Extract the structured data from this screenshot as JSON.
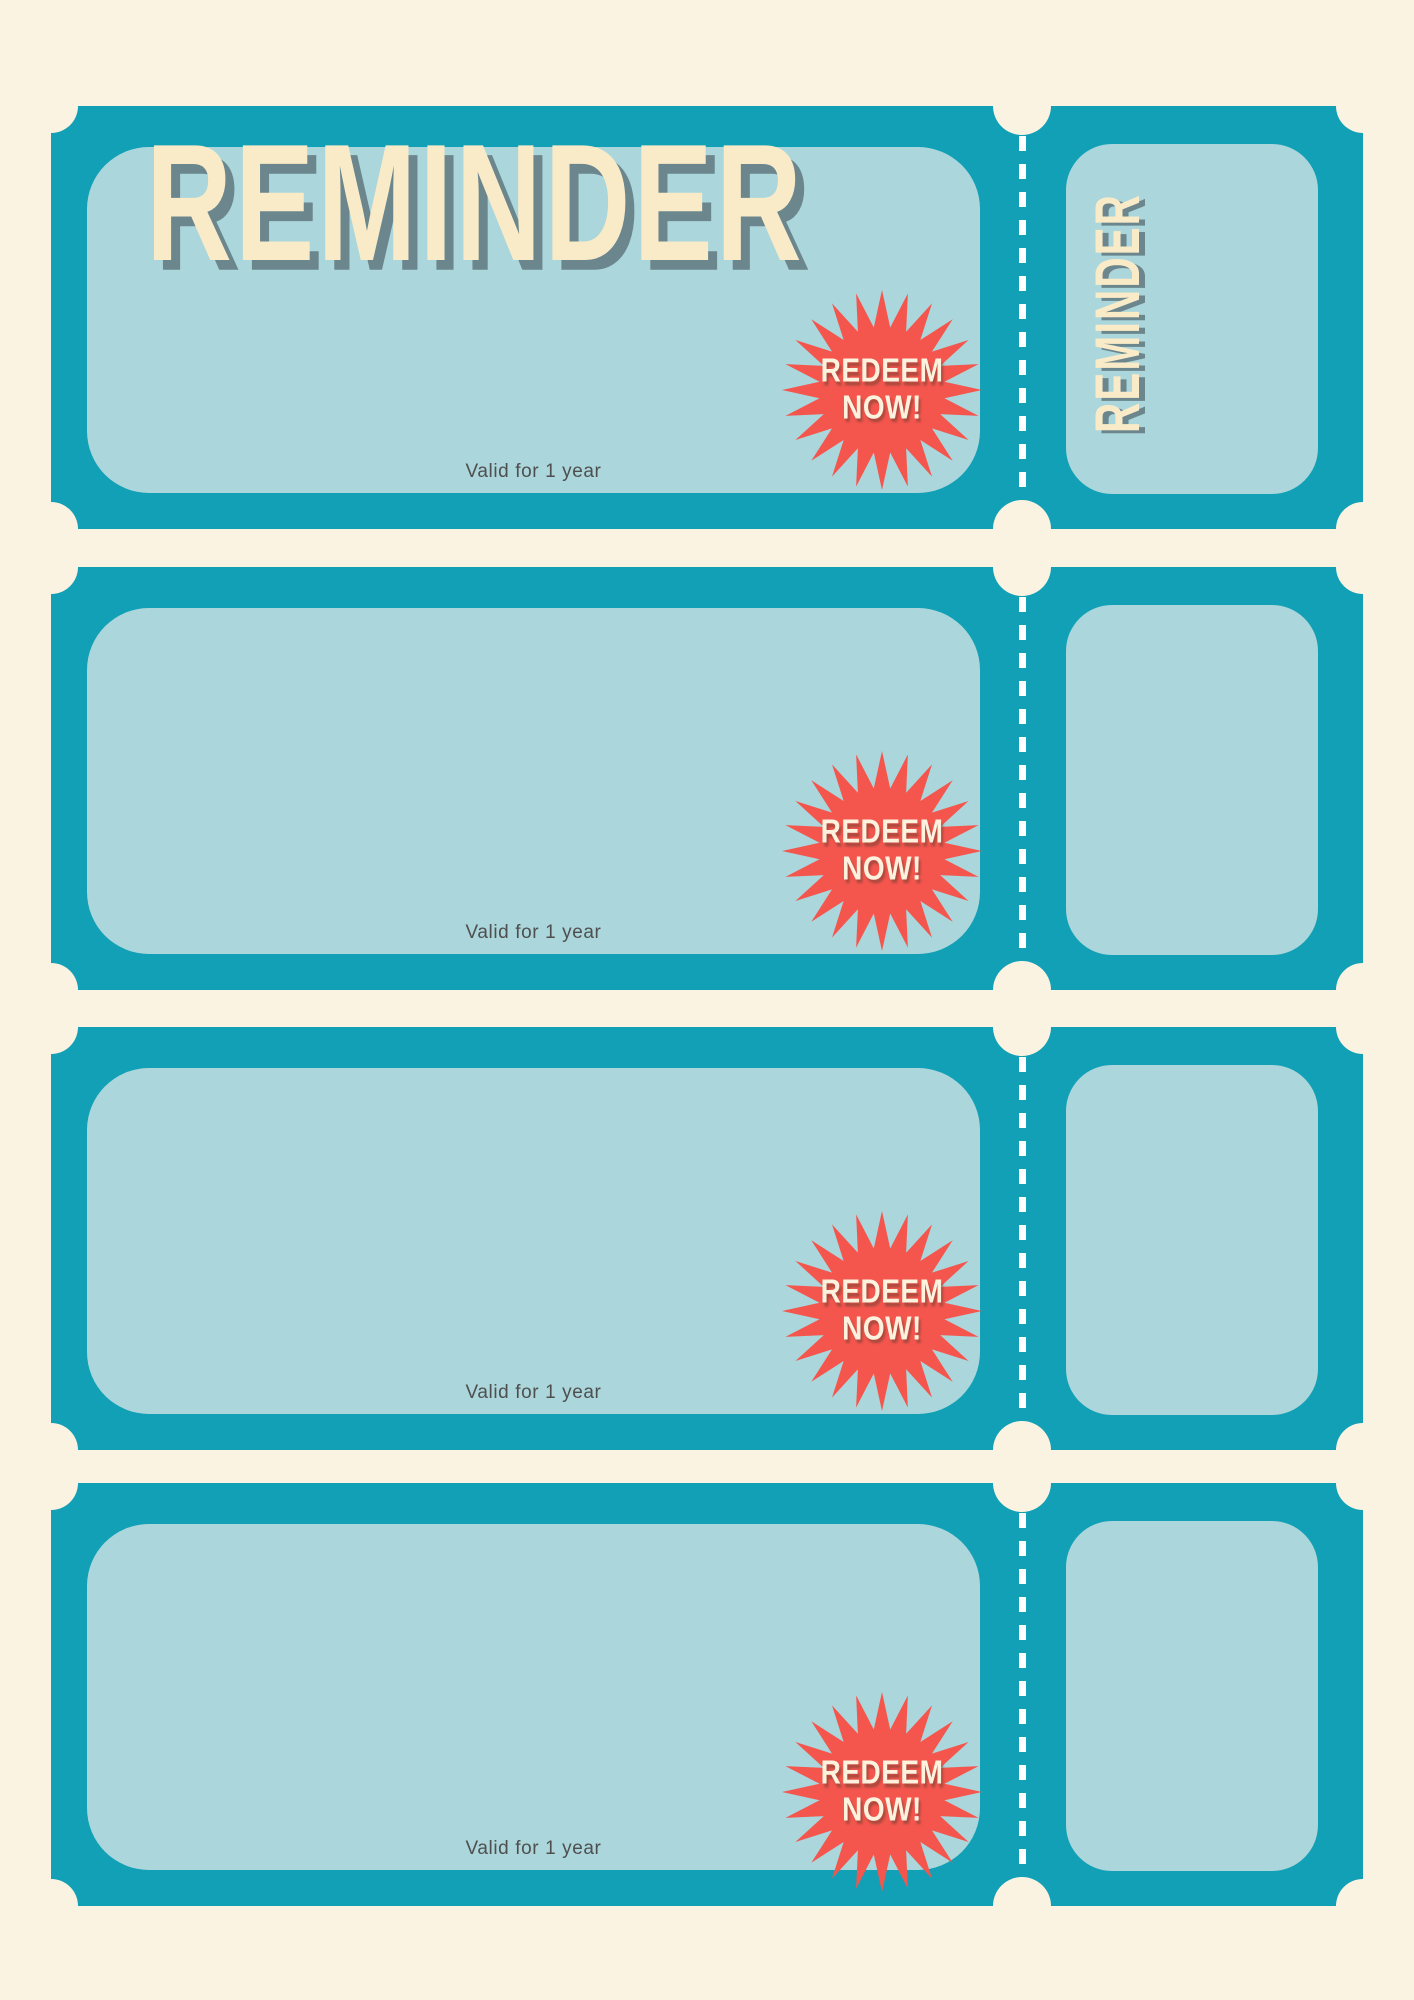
{
  "colors": {
    "teal": "#11A0B5",
    "light_blue": "#ABD6DB",
    "cream": "#FBF3E2",
    "red": "#F4564E",
    "title_cream": "#F9EBC8",
    "title_shadow": "#6B868D",
    "validity_gray": "#4F4F4F",
    "badge_cream": "#FCF2DE",
    "dash_white": "#FFFFFF"
  },
  "tickets": [
    {
      "title": "REMINDER",
      "stub_label": "REMINDER",
      "badge": {
        "line1": "REDEEM",
        "line2": "NOW!"
      },
      "validity": "Valid for 1 year"
    },
    {
      "badge": {
        "line1": "REDEEM",
        "line2": "NOW!"
      },
      "validity": "Valid for 1 year"
    },
    {
      "badge": {
        "line1": "REDEEM",
        "line2": "NOW!"
      },
      "validity": "Valid for 1 year"
    },
    {
      "badge": {
        "line1": "REDEEM",
        "line2": "NOW!"
      },
      "validity": "Valid for 1 year"
    }
  ]
}
